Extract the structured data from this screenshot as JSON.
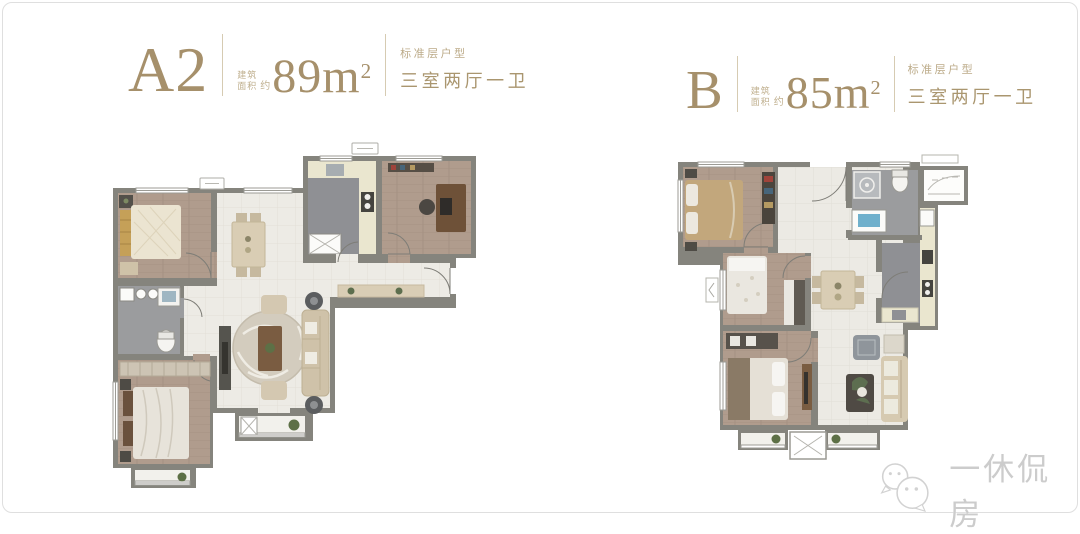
{
  "header_left": {
    "name": "A2",
    "area_label": [
      "建筑",
      "面积"
    ],
    "approx": "约",
    "area_number": "89",
    "area_unit": "m",
    "area_exponent": "2",
    "floor_type": "标准层户型",
    "layout_type": "三室两厅一卫"
  },
  "header_right": {
    "name": "B",
    "area_label": [
      "建筑",
      "面积"
    ],
    "approx": "约",
    "area_number": "85",
    "area_unit": "m",
    "area_exponent": "2",
    "floor_type": "标准层户型",
    "layout_type": "三室两厅一卫"
  },
  "watermark": {
    "brand": "一休侃房"
  },
  "colors": {
    "accent_gold": "#a6906b",
    "accent_gold_light": "#c0b08f",
    "wall": "#85847d",
    "wood_floor": "#b09c8d",
    "tile_floor": "#edebe5",
    "wet_floor": "#95969a",
    "counter": "#eae6cf",
    "frame_border": "#dfdfdf",
    "watermark_gray": "#cccccc"
  }
}
